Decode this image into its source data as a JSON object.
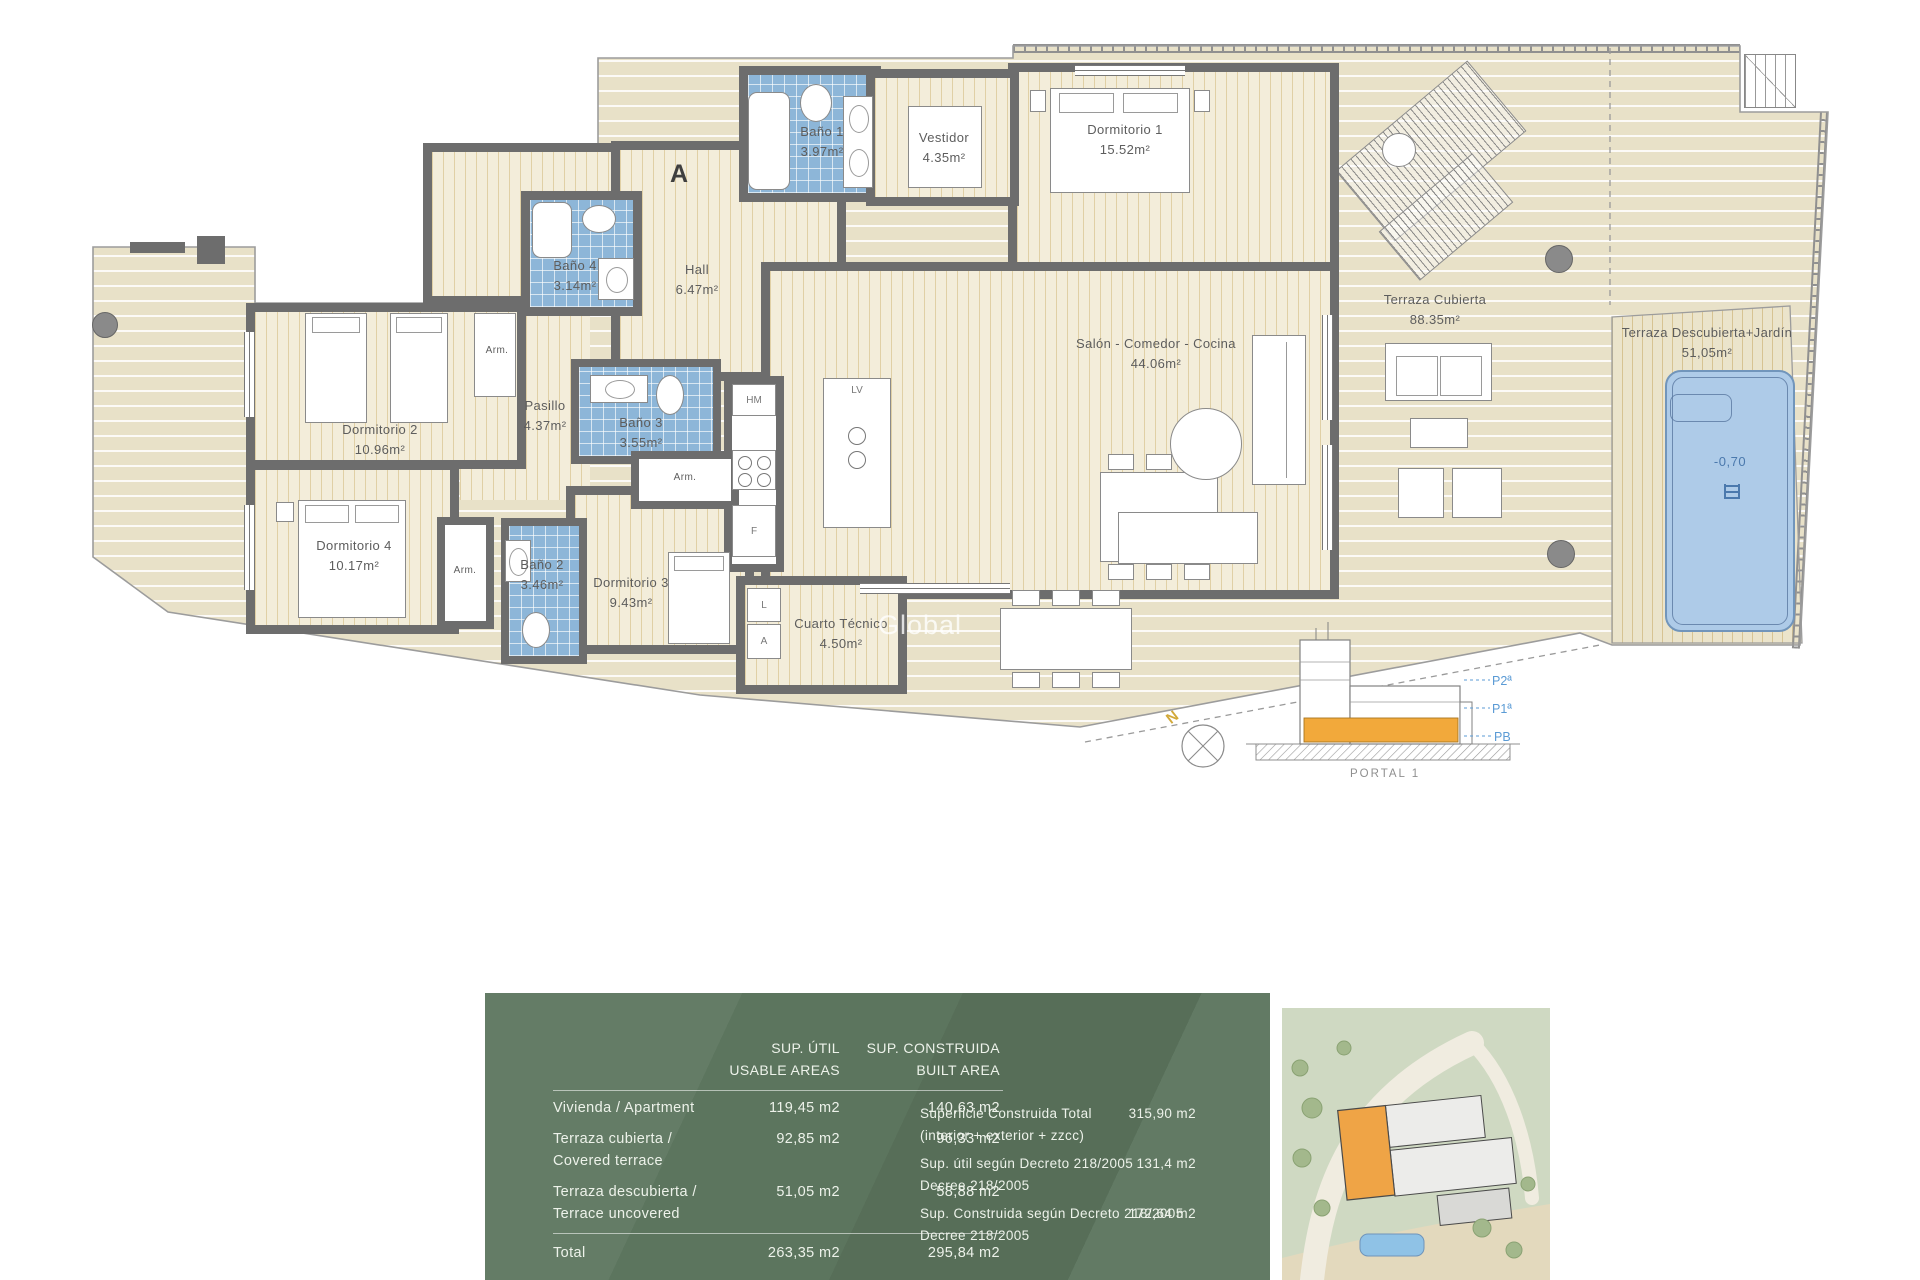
{
  "plan": {
    "door_marker": "A",
    "closet_label": "Arm.",
    "watermark": "Global",
    "pool_level": "-0,70",
    "appliances": {
      "hm": "HM",
      "lv": "LV",
      "f": "F",
      "l": "L",
      "a": "A"
    },
    "rooms": [
      {
        "id": "bano1",
        "name": "Baño 1",
        "area": "3.97m²"
      },
      {
        "id": "vestidor",
        "name": "Vestidor",
        "area": "4.35m²"
      },
      {
        "id": "dorm1",
        "name": "Dormitorio 1",
        "area": "15.52m²"
      },
      {
        "id": "bano4",
        "name": "Baño 4",
        "area": "3.14m²"
      },
      {
        "id": "hall",
        "name": "Hall",
        "area": "6.47m²"
      },
      {
        "id": "dorm2",
        "name": "Dormitorio 2",
        "area": "10.96m²"
      },
      {
        "id": "pasillo",
        "name": "Pasillo",
        "area": "4.37m²"
      },
      {
        "id": "bano3",
        "name": "Baño 3",
        "area": "3.55m²"
      },
      {
        "id": "salon",
        "name": "Salón - Comedor - Cocina",
        "area": "44.06m²"
      },
      {
        "id": "dorm4",
        "name": "Dormitorio 4",
        "area": "10.17m²"
      },
      {
        "id": "bano2",
        "name": "Baño 2",
        "area": "3.46m²"
      },
      {
        "id": "dorm3",
        "name": "Dormitorio 3",
        "area": "9.43m²"
      },
      {
        "id": "cuarto",
        "name": "Cuarto Técnico",
        "area": "4.50m²"
      },
      {
        "id": "terraza_cubierta",
        "name": "Terraza  Cubierta",
        "area": "88.35m²"
      },
      {
        "id": "terraza_descubierta",
        "name": "Terraza Descubierta+Jardín",
        "area": "51,05m²"
      }
    ],
    "compass_north": "N",
    "section": {
      "portal": "PORTAL 1",
      "floors": [
        "P2ª",
        "P1ª",
        "PB"
      ]
    }
  },
  "table": {
    "col1_header_line1": "SUP. ÚTIL",
    "col1_header_line2": "USABLE AREAS",
    "col2_header_line1": "SUP. CONSTRUIDA",
    "col2_header_line2": "BUILT AREA",
    "rows": [
      {
        "label_line1": "Vivienda / Apartment",
        "label_line2": "",
        "util": "119,45 m2",
        "built": "140,63 m2"
      },
      {
        "label_line1": "Terraza cubierta /",
        "label_line2": "Covered terrace",
        "util": "92,85 m2",
        "built": "96,33 m2"
      },
      {
        "label_line1": "Terraza descubierta /",
        "label_line2": "Terrace uncovered",
        "util": "51,05 m2",
        "built": "58,88 m2"
      }
    ],
    "total": {
      "label": "Total",
      "util": "263,35 m2",
      "built": "295,84 m2"
    }
  },
  "summary": {
    "rows": [
      {
        "line1": "Superficie Construida Total",
        "line2": "(interior + exterior + zzcc)",
        "value": "315,90 m2"
      },
      {
        "line1": "Sup. útil según Decreto 218/2005",
        "line2": "Decree 218/2005",
        "value": "131,4 m2"
      },
      {
        "line1": "Sup. Construida según Decreto 218/2005",
        "line2": "Decree 218/2005",
        "value": "172,64 m2"
      }
    ]
  },
  "colors": {
    "panel_green": "#5c755e",
    "orange_highlight": "#f2a93b",
    "floor_label_blue": "#5b9bd5",
    "bath_blue": "#8db6d8",
    "pool_blue": "#aecbe8",
    "north_yellow": "#d2a93a",
    "wall_gray": "#6d6d6d"
  }
}
